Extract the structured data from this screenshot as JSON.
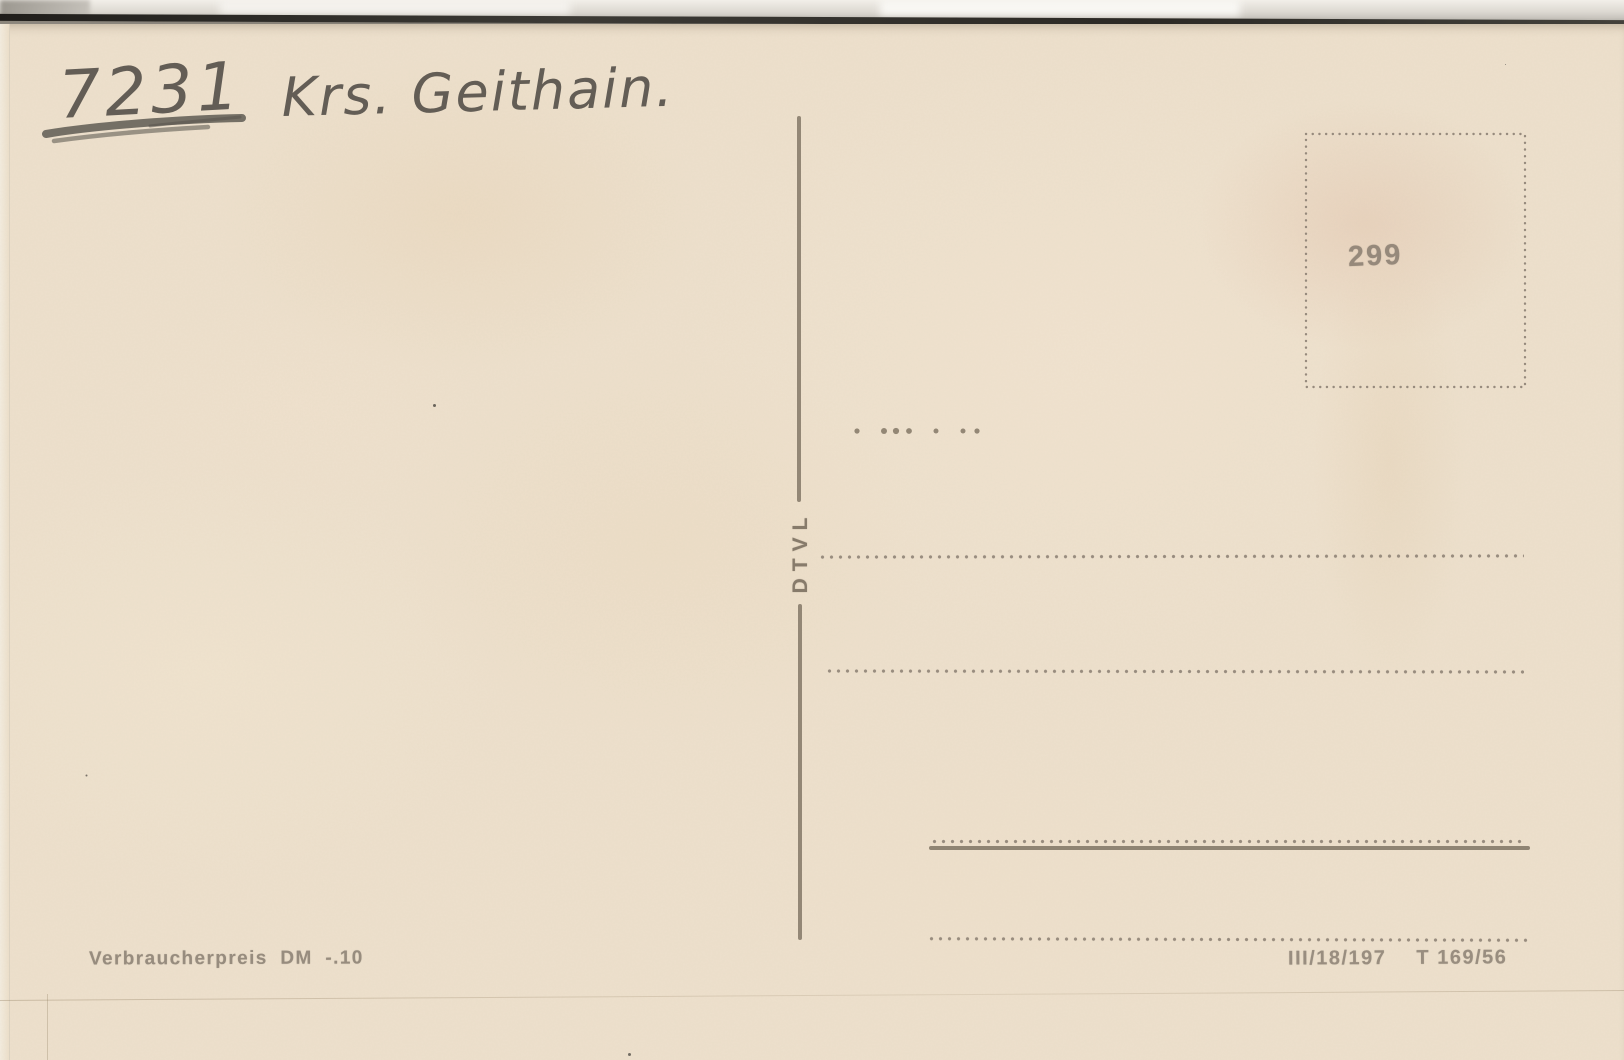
{
  "card": {
    "handwriting": {
      "postal_code": "7231",
      "district": "Krs. Geithain."
    },
    "stamp_box": {
      "number": "299"
    },
    "divider_label": "DTVL",
    "footer": {
      "price_note": "Verbraucherpreis DM -.10",
      "print_code": "III/18/197",
      "series_code": "T 169/56"
    },
    "colors": {
      "paper": "#ede0cc",
      "printed_ink": "#8b7f6f",
      "pencil": "#514c46",
      "scanner_background": "#d8d4cd",
      "edge_shadow": "#2b2925"
    }
  }
}
